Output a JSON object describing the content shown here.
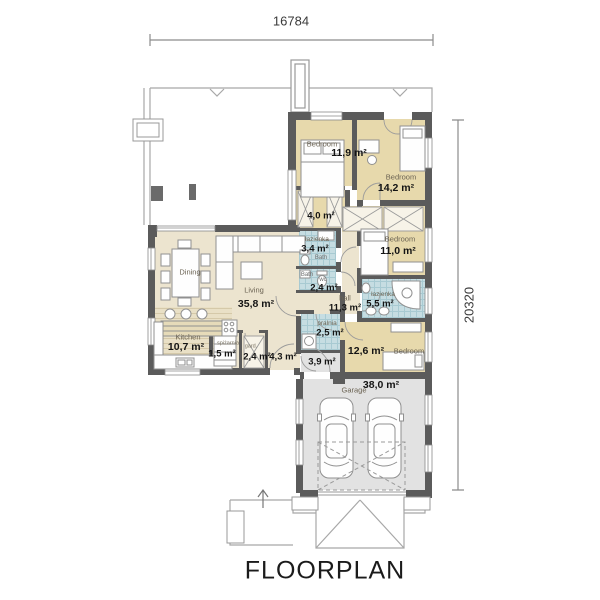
{
  "title": "FLOORPLAN",
  "dimensions": {
    "width": "16784",
    "height": "20320"
  },
  "colors": {
    "wall": "#5b5b5b",
    "floor_beige": "#ece4cf",
    "floor_tan": "#e7d9ac",
    "tile_blue": "#c6dde2",
    "floor_gray": "#e2e2e2",
    "outline": "#9a9a9a"
  },
  "rooms": {
    "bedroom1": {
      "name": "Bedroom",
      "area": "11,9 m²"
    },
    "bedroom2": {
      "name": "Bedroom",
      "area": "14,2 m²"
    },
    "corridor": {
      "area": "4,0 m²"
    },
    "bath1": {
      "name": "łazienka",
      "area": "3,4 m²",
      "sub": "Bath"
    },
    "bath2": {
      "name": "Bath",
      "sub": "wc",
      "area": "2,4 m²"
    },
    "bedroom3": {
      "name": "Bedroom",
      "area": "11,0 m²"
    },
    "hall": {
      "name": "hall",
      "area": "11,3 m²"
    },
    "bath3": {
      "name": "łazienka",
      "area": "5,5 m²"
    },
    "dining": {
      "name": "Dining"
    },
    "living": {
      "name": "Living",
      "area": "35,8 m²"
    },
    "kitchen": {
      "name": "Kitchen",
      "area": "10,7 m²"
    },
    "pantry": {
      "name": "spiżarnia",
      "area": "1,5 m²"
    },
    "wardrobe": {
      "name": "gard.",
      "area": "2,4 m²"
    },
    "hallway2": {
      "area": "4,3 m²"
    },
    "laundry": {
      "name": "pralnia",
      "area": "2,5 m²"
    },
    "entry": {
      "area": "3,9 m²"
    },
    "bedroom4": {
      "name": "Bedroom",
      "area": "12,6 m²"
    },
    "garage": {
      "name": "Garage",
      "area": "38,0 m²"
    }
  }
}
